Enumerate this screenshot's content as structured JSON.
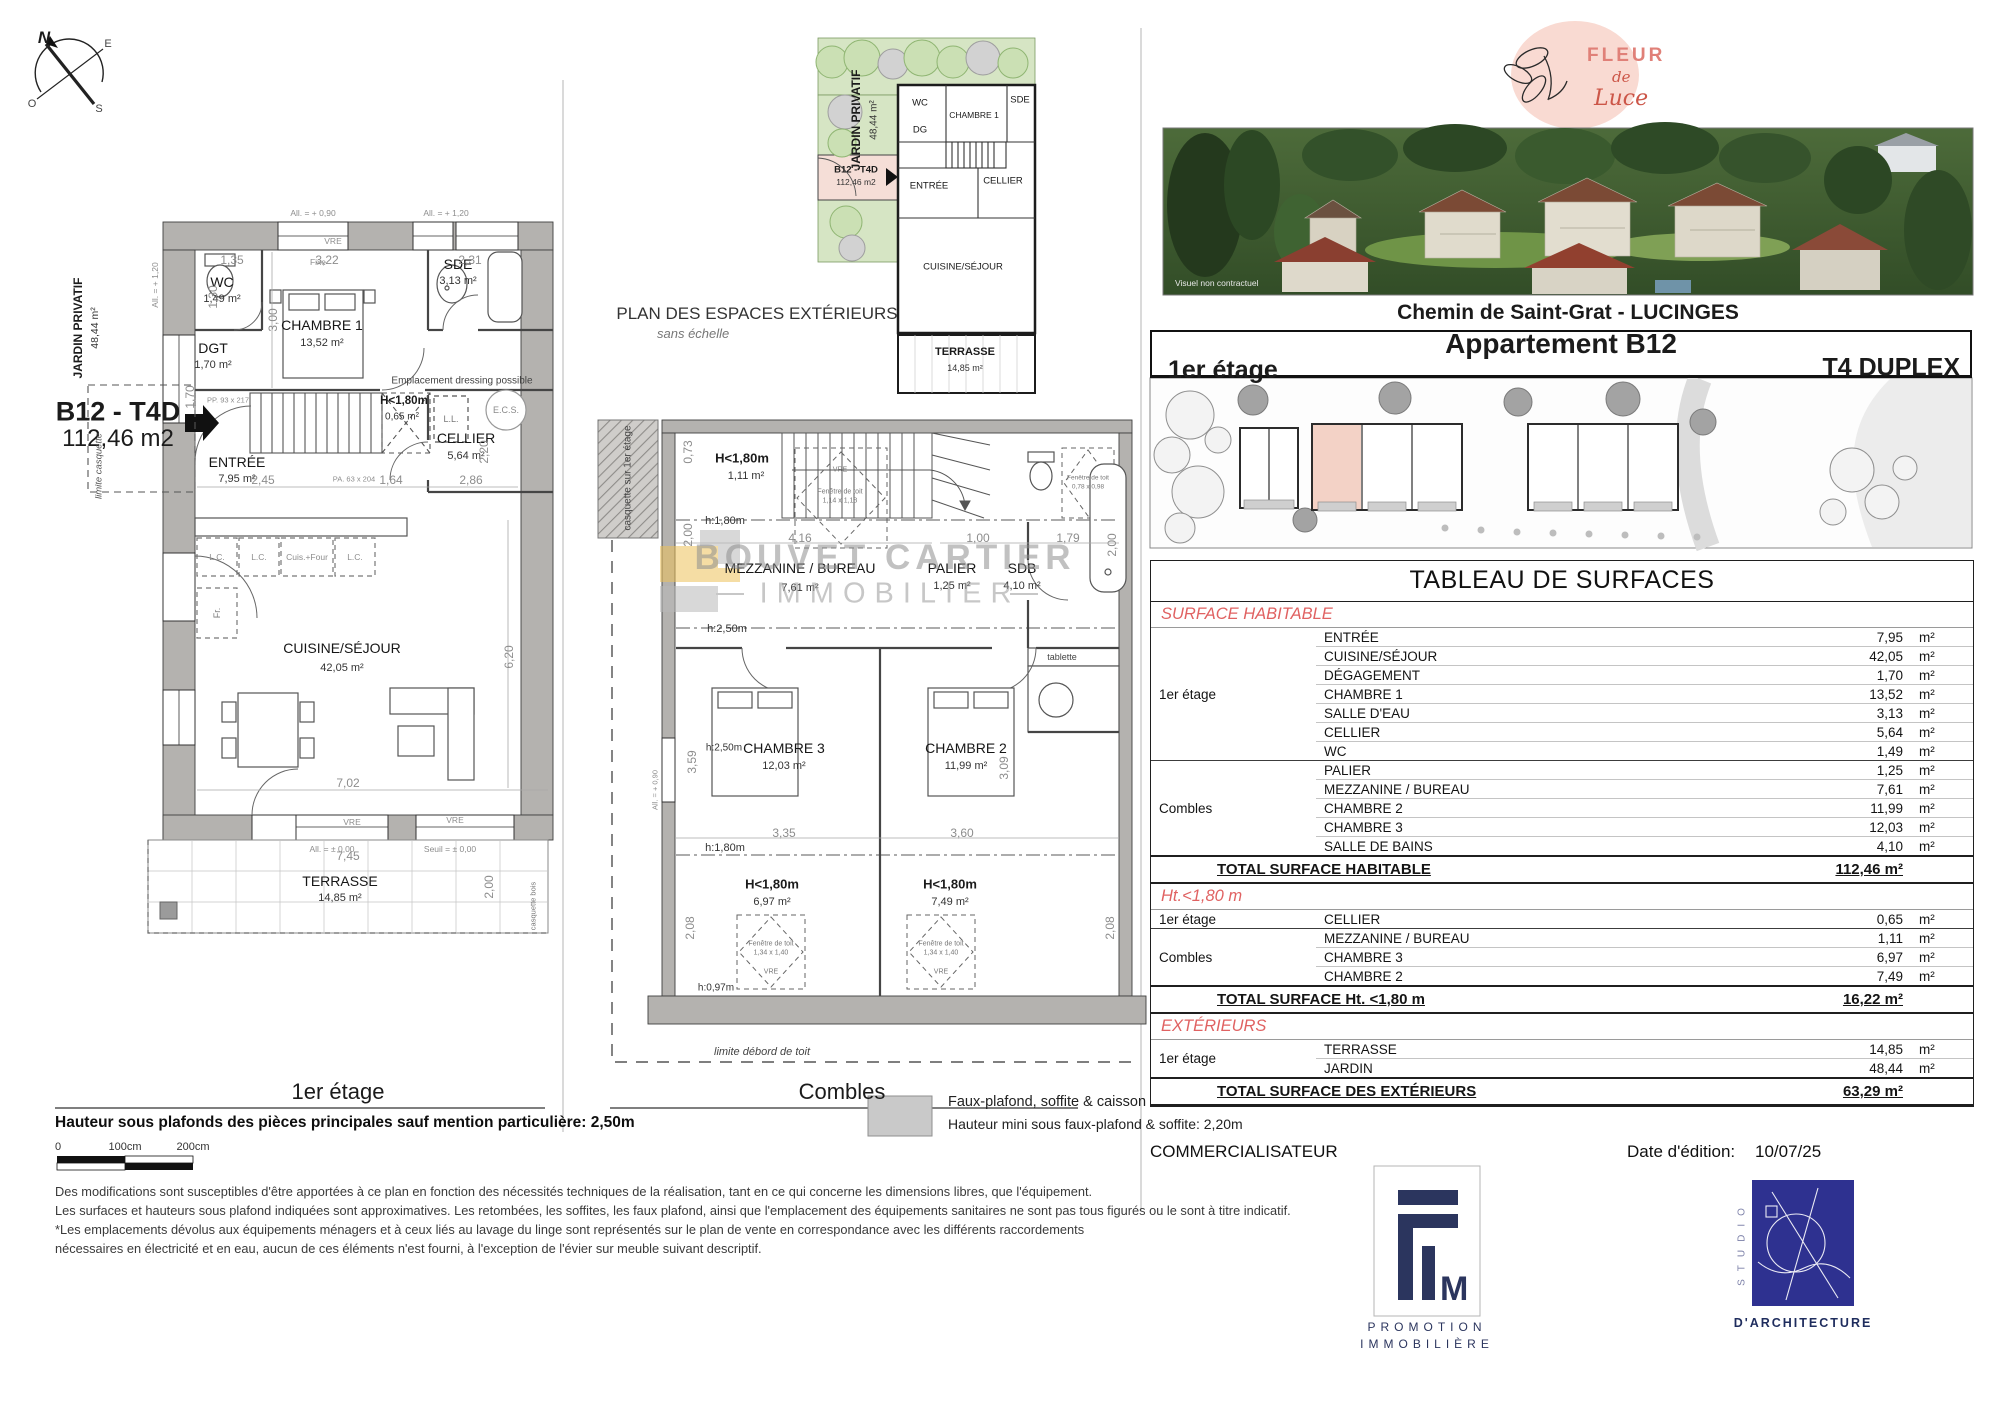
{
  "compass": {
    "n": "N",
    "e": "E",
    "s": "S",
    "o": "O"
  },
  "left_plan": {
    "title": "1er étage",
    "jardin_label": "JARDIN PRIVATIF",
    "jardin_area": "48,44 m²",
    "unit_code": "B12 - T4D",
    "unit_area": "112,46 m2",
    "limite": "limite casquette",
    "rooms": {
      "wc": {
        "name": "WC",
        "area": "1,49 m²"
      },
      "dgt": {
        "name": "DGT",
        "area": "1,70 m²"
      },
      "ch1": {
        "name": "CHAMBRE 1",
        "area": "13,52 m²"
      },
      "sde": {
        "name": "SDE",
        "area": "3,13 m²"
      },
      "h180": {
        "name": "H<1,80m",
        "area": "0,65 m²"
      },
      "cellier": {
        "name": "CELLIER",
        "area": "5,64 m²"
      },
      "entree": {
        "name": "ENTRÉE",
        "area": "7,95 m²"
      },
      "cuisine": {
        "name": "CUISINE/SÉJOUR",
        "area": "42,05 m²"
      },
      "terrasse": {
        "name": "TERRASSE",
        "area": "14,85 m²"
      }
    },
    "ecs": "E.C.S.",
    "ll": "L.L.",
    "fr": "Fr.",
    "fixe": "Fixe",
    "vre": "VRE",
    "counters": [
      "L.C.",
      "L.C.",
      "Cuis.+Four",
      "L.C."
    ],
    "dressing": "Emplacement dressing possible",
    "pp": "PP. 93 x 217",
    "pa": "PA. 63 x 204",
    "all090": "All. = + 0,90",
    "all120": "All. = + 1,20",
    "alt120": "All. = + 1,20",
    "all000": "All. = ± 0,00",
    "seuil": "Seuil = ± 0,00",
    "casq_bois": "casquette bois",
    "dims": {
      "d135": "1,35",
      "d322": "3,22",
      "d231": "2,31",
      "d300": "3,00",
      "d130": "1,30",
      "d170": "1,70",
      "d245": "2,45",
      "d164": "1,64",
      "d286": "2,86",
      "d220": "2,20",
      "d620": "6,20",
      "d702": "7,02",
      "d745": "7,45",
      "d200": "2,00"
    }
  },
  "exterior_plan": {
    "heading": "PLAN DES ESPACES EXTÉRIEURS",
    "subheading": "sans échelle",
    "jardin_label": "JARDIN PRIVATIF",
    "jardin_area": "48,44 m²",
    "unit_code": "B12 - T4D",
    "unit_area": "112,46 m2",
    "rooms": {
      "wc": "WC",
      "dg": "DG",
      "ch1": "CHAMBRE 1",
      "sde": "SDE",
      "entree": "ENTRÉE",
      "cellier": "CELLIER",
      "cuisine": "CUISINE/SÉJOUR",
      "terrasse": "TERRASSE",
      "terrasse_area": "14,85 m²"
    }
  },
  "combles": {
    "title": "Combles",
    "casquette": "casquette sur 1er étage",
    "rooms": {
      "h111": {
        "name": "H<1,80m",
        "area": "1,11 m²"
      },
      "mezz": {
        "name": "MEZZANINE / BUREAU",
        "area": "7,61 m²"
      },
      "palier": {
        "name": "PALIER",
        "area": "1,25 m²"
      },
      "sdb": {
        "name": "SDB",
        "area": "4,10 m²"
      },
      "ch3": {
        "name": "CHAMBRE 3",
        "area": "12,03 m²"
      },
      "ch2": {
        "name": "CHAMBRE 2",
        "area": "11,99 m²"
      },
      "h697": {
        "name": "H<1,80m",
        "area": "6,97 m²"
      },
      "h749": {
        "name": "H<1,80m",
        "area": "7,49 m²"
      }
    },
    "h180": "h:1,80m",
    "h250a": "h:2,50m",
    "h250b": "h:2,50m",
    "h180b": "h:1,80m",
    "h097": "h:0,97m",
    "tablette": "tablette",
    "vre": "VRE",
    "all090": "All. = + 0,90",
    "fen_a1": "Fenêtre de toit",
    "fen_a2": "1,14 x 1,18",
    "fen_b1": "Fenêtre de toit",
    "fen_b2": "0,78 x 0,98",
    "fen_c1": "Fenêtre de toit",
    "fen_c2": "1,34 x 1,40",
    "limite": "limite débord de toit",
    "dims": {
      "d073": "0,73",
      "d200l": "2,00",
      "d416": "4,16",
      "d100": "1,00",
      "d179": "1,79",
      "d200r": "2,00",
      "d335": "3,35",
      "d360": "3,60",
      "d359": "3,59",
      "d309": "3,09",
      "d208l": "2,08",
      "d208r": "2,08"
    }
  },
  "legend": {
    "line1": "Faux-plafond, soffite & caisson au sol",
    "line2": "Hauteur mini sous faux-plafond & soffite: 2,20m"
  },
  "watermark": {
    "line1": "BOUVET CARTIER",
    "line2": "IMMOBILIER"
  },
  "notes": {
    "bold": "Hauteur sous plafonds des pièces principales sauf mention particulière: 2,50m",
    "scale": [
      "0",
      "100cm",
      "200cm"
    ],
    "lines": [
      "Des modifications sont susceptibles d'être apportées à ce plan en fonction des nécessités techniques de la réalisation, tant en ce qui concerne les dimensions libres, que l'équipement.",
      "Les surfaces et hauteurs sous plafond indiquées sont approximatives. Les retombées, les soffites, les faux plafond, ainsi que l'emplacement des équipements sanitaires ne sont pas tous figurés ou le sont à titre indicatif.",
      "*Les emplacements dévolus aux équipements ménagers et à ceux liés au lavage du linge sont représentés sur le plan de vente en correspondance avec les différents raccordements",
      "nécessaires en électricité et en eau, aucun de ces éléments n'est fourni, à l'exception de l'évier sur meuble suivant descriptif."
    ]
  },
  "brand": {
    "fleur": {
      "w1": "FLEUR",
      "w2": "de",
      "w3": "Luce"
    },
    "photo_caption": "Visuel non contractuel",
    "address": "Chemin de Saint-Grat - LUCINGES"
  },
  "header": {
    "title": "Appartement B12",
    "floor": "1er étage",
    "type": "T4 DUPLEX"
  },
  "surface_table": {
    "title": "TABLEAU DE SURFACES",
    "unit": "m²",
    "sections": [
      {
        "heading": "SURFACE HABITABLE",
        "groups": [
          {
            "label": "1er étage",
            "rows": [
              [
                "ENTRÉE",
                "7,95"
              ],
              [
                "CUISINE/SÉJOUR",
                "42,05"
              ],
              [
                "DÉGAGEMENT",
                "1,70"
              ],
              [
                "CHAMBRE 1",
                "13,52"
              ],
              [
                "SALLE D'EAU",
                "3,13"
              ],
              [
                "CELLIER",
                "5,64"
              ],
              [
                "WC",
                "1,49"
              ]
            ]
          },
          {
            "label": "Combles",
            "rows": [
              [
                "PALIER",
                "1,25"
              ],
              [
                "MEZZANINE / BUREAU",
                "7,61"
              ],
              [
                "CHAMBRE 2",
                "11,99"
              ],
              [
                "CHAMBRE 3",
                "12,03"
              ],
              [
                "SALLE DE BAINS",
                "4,10"
              ]
            ]
          }
        ],
        "total": [
          "TOTAL SURFACE HABITABLE",
          "112,46 m²"
        ]
      },
      {
        "heading": "Ht.<1,80 m",
        "groups": [
          {
            "label": "1er étage",
            "rows": [
              [
                "CELLIER",
                "0,65"
              ]
            ]
          },
          {
            "label": "Combles",
            "rows": [
              [
                "MEZZANINE / BUREAU",
                "1,11"
              ],
              [
                "CHAMBRE 3",
                "6,97"
              ],
              [
                "CHAMBRE 2",
                "7,49"
              ]
            ]
          }
        ],
        "total": [
          "TOTAL SURFACE Ht. <1,80 m",
          "16,22 m²"
        ]
      },
      {
        "heading": "EXTÉRIEURS",
        "groups": [
          {
            "label": "1er étage",
            "rows": [
              [
                "TERRASSE",
                "14,85"
              ],
              [
                "JARDIN",
                "48,44"
              ]
            ]
          }
        ],
        "total": [
          "TOTAL SURFACE  DES EXTÉRIEURS",
          "63,29 m²"
        ]
      }
    ]
  },
  "footer": {
    "commercialisateur": "COMMERCIALISATEUR",
    "date_label": "Date d'édition:",
    "date_value": "10/07/25",
    "fim": {
      "letters": "M",
      "sub1": "PROMOTION",
      "sub2": "IMMOBILIÈRE"
    },
    "studio": {
      "vertical": "STUDIO",
      "caption": "D'ARCHITECTURE"
    }
  }
}
